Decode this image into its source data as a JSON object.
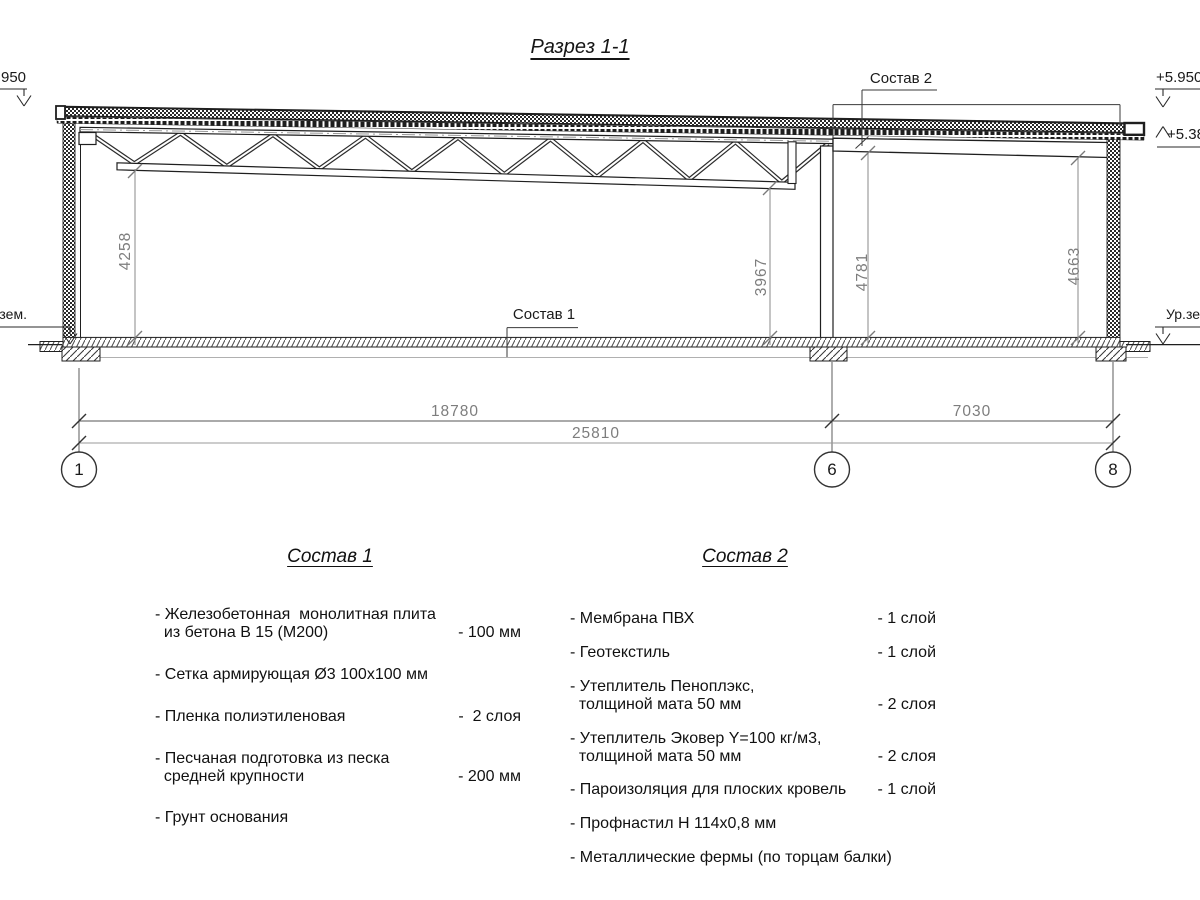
{
  "title": "Разрез 1-1",
  "colors": {
    "line": "#1f1f1f",
    "dimension_text": "#7d7d7d"
  },
  "drawing": {
    "composition1_label": "Состав 1",
    "composition2_label": "Состав 2",
    "elevation_left": "+5.950",
    "elevation_right_top": "+5.950",
    "elevation_right_mid": "+5.380",
    "ground_level_left": "Ур.зем.",
    "ground_level_right": "Ур.зем.",
    "dim_height_1": "4258",
    "dim_height_2": "3967",
    "dim_height_3": "4781",
    "dim_height_4": "4663",
    "dim_span_1": "18780",
    "dim_span_2": "7030",
    "dim_total": "25810",
    "axis_1": "1",
    "axis_6": "6",
    "axis_8": "8"
  },
  "spec1": {
    "title": "Состав 1",
    "items": [
      {
        "text": "- Железобетонная  монолитная плита\n  из бетона В 15 (М200)",
        "value": "- 100 мм"
      },
      {
        "text": "- Сетка армирующая Ø3 100х100 мм",
        "value": ""
      },
      {
        "text": "- Пленка полиэтиленовая",
        "value": "-  2 слоя"
      },
      {
        "text": "- Песчаная подготовка из песка\n  средней крупности",
        "value": "- 200 мм"
      },
      {
        "text": "- Грунт основания",
        "value": ""
      }
    ]
  },
  "spec2": {
    "title": "Состав 2",
    "items": [
      {
        "text": "- Мембрана ПВХ",
        "value": "- 1 слой"
      },
      {
        "text": "- Геотекстиль",
        "value": "- 1 слой"
      },
      {
        "text": "- Утеплитель Пеноплэкс,\n  толщиной мата 50 мм",
        "value": "- 2 слоя"
      },
      {
        "text": "- Утеплитель Эковер Y=100 кг/м3,\n  толщиной мата 50 мм",
        "value": "- 2 слоя"
      },
      {
        "text": "- Пароизоляция для плоских кровель",
        "value": "- 1 слой"
      },
      {
        "text": "- Профнастил Н 114х0,8 мм",
        "value": ""
      },
      {
        "text": "- Металлические фермы (по торцам балки)",
        "value": ""
      }
    ]
  }
}
